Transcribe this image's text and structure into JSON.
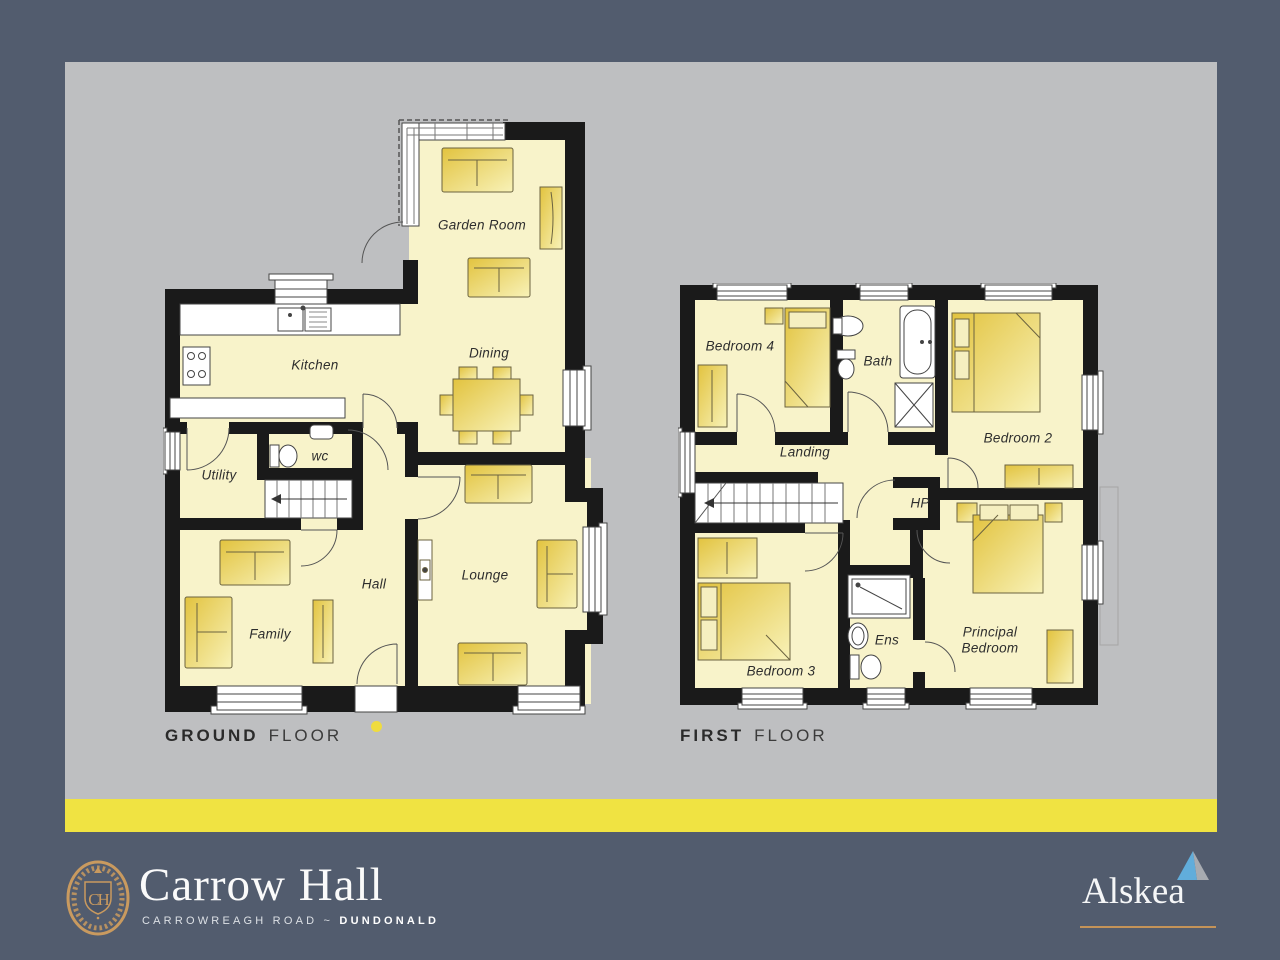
{
  "colors": {
    "background": "#525C6E",
    "panel": "#BEBFC1",
    "accent_stripe": "#F0E342",
    "plan_floor_fill": "#F8F3CA",
    "wall": "#1A1A1A",
    "furniture_dark": "#E2C33F",
    "furniture_light": "#F8F2B8",
    "brand_gold": "#C99A5F",
    "alskea_triangle_blue": "#61ADDB",
    "alskea_triangle_gray": "#A7ABB1"
  },
  "plans": {
    "ground": {
      "caption_primary": "GROUND",
      "caption_secondary": "FLOOR",
      "labels": {
        "garden_room": "Garden Room",
        "dining": "Dining",
        "kitchen": "Kitchen",
        "utility": "Utility",
        "wc": "wc",
        "hall": "Hall",
        "family": "Family",
        "lounge": "Lounge"
      }
    },
    "first": {
      "caption_primary": "FIRST",
      "caption_secondary": "FLOOR",
      "labels": {
        "bedroom4": "Bedroom 4",
        "bath": "Bath",
        "bedroom2": "Bedroom 2",
        "landing": "Landing",
        "hp": "HP",
        "bedroom3": "Bedroom 3",
        "ens": "Ens",
        "principal": "Principal Bedroom"
      }
    }
  },
  "footer": {
    "crest_monogram": "CH",
    "development_name": "Carrow Hall",
    "address_road": "CARROWREAGH ROAD",
    "address_separator": "~",
    "address_town": "DUNDONALD",
    "agent_name": "Alskea"
  }
}
